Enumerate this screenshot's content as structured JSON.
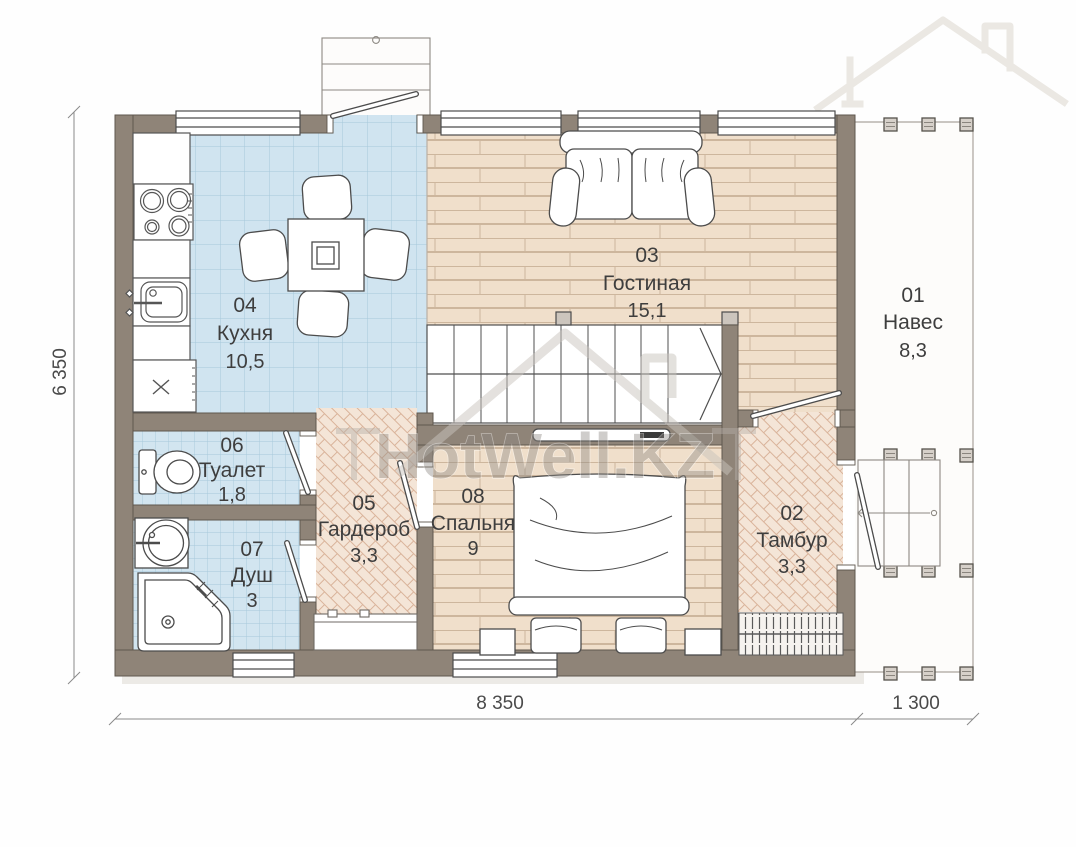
{
  "plan": {
    "watermark": "HotWell.KZ",
    "rooms": [
      {
        "num": "04",
        "name": "Кухня",
        "area": "10,5"
      },
      {
        "num": "03",
        "name": "Гостиная",
        "area": "15,1"
      },
      {
        "num": "01",
        "name": "Навес",
        "area": "8,3"
      },
      {
        "num": "06",
        "name": "Туалет",
        "area": "1,8"
      },
      {
        "num": "07",
        "name": "Душ",
        "area": "3"
      },
      {
        "num": "05",
        "name": "Гардероб",
        "area": "3,3"
      },
      {
        "num": "08",
        "name": "Спальня",
        "area": "9"
      },
      {
        "num": "02",
        "name": "Тамбур",
        "area": "3,3"
      }
    ],
    "dimensions": {
      "left_height": "6 350",
      "bottom_width": "8 350",
      "canopy_width": "1 300"
    },
    "colors": {
      "wall": "#8f8478",
      "kitchen_tile": "#d0e4f0",
      "wood_floor": "#f0dfcb",
      "herringbone_floor": "#f4e5d7"
    }
  }
}
